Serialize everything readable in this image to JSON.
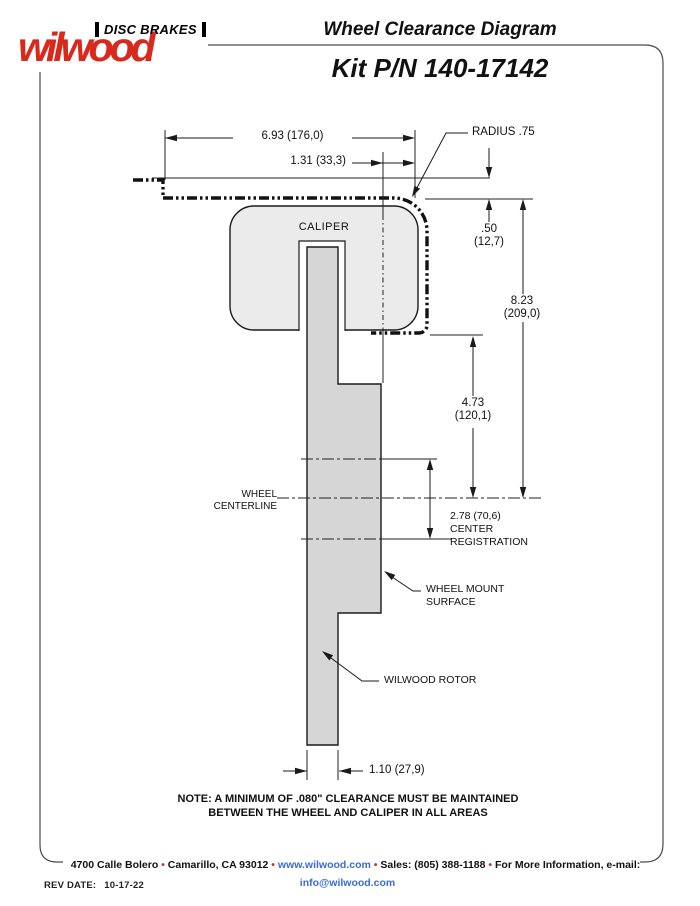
{
  "colors": {
    "brand_red": "#d9291c",
    "link_blue": "#3b6bd6",
    "bullet_red": "#c0392b",
    "caliper_fill": "#ebebeb",
    "rotor_fill": "#d6d6d6",
    "line_black": "#1a1a1a"
  },
  "header": {
    "brand_top": "DISC BRAKES",
    "brand_script": "wilwood",
    "doc_title": "Wheel Clearance Diagram",
    "kit_title": "Kit P/N 140-17142"
  },
  "diagram": {
    "caliper_label": "CALIPER",
    "dims": {
      "width_top": "6.93 (176,0)",
      "offset_top": "1.31 (33,3)",
      "radius": "RADIUS .75",
      "d50_in": ".50",
      "d50_mm": "(12,7)",
      "d823_in": "8.23",
      "d823_mm": "(209,0)",
      "d473_in": "4.73",
      "d473_mm": "(120,1)",
      "center_reg_value": "2.78 (70,6)",
      "center_reg_l2": "CENTER",
      "center_reg_l3": "REGISTRATION",
      "rotor_width": "1.10 (27,9)"
    },
    "labels": {
      "wheel_cl_l1": "WHEEL",
      "wheel_cl_l2": "CENTERLINE",
      "mount_l1": "WHEEL MOUNT",
      "mount_l2": "SURFACE",
      "rotor": "WILWOOD ROTOR"
    },
    "note_l1": "NOTE: A MINIMUM OF .080\" CLEARANCE MUST BE MAINTAINED",
    "note_l2": "BETWEEN THE WHEEL AND CALIPER IN ALL AREAS"
  },
  "footer": {
    "seg1": "4700 Calle Bolero",
    "seg2": "Camarillo, CA 93012",
    "web": "www.wilwood.com",
    "seg3": "Sales: (805) 388-1188",
    "seg4": "For More Information, e-mail:",
    "email": "info@wilwood.com",
    "bullet": "•",
    "rev_label": "REV DATE:",
    "rev_value": "10-17-22"
  }
}
